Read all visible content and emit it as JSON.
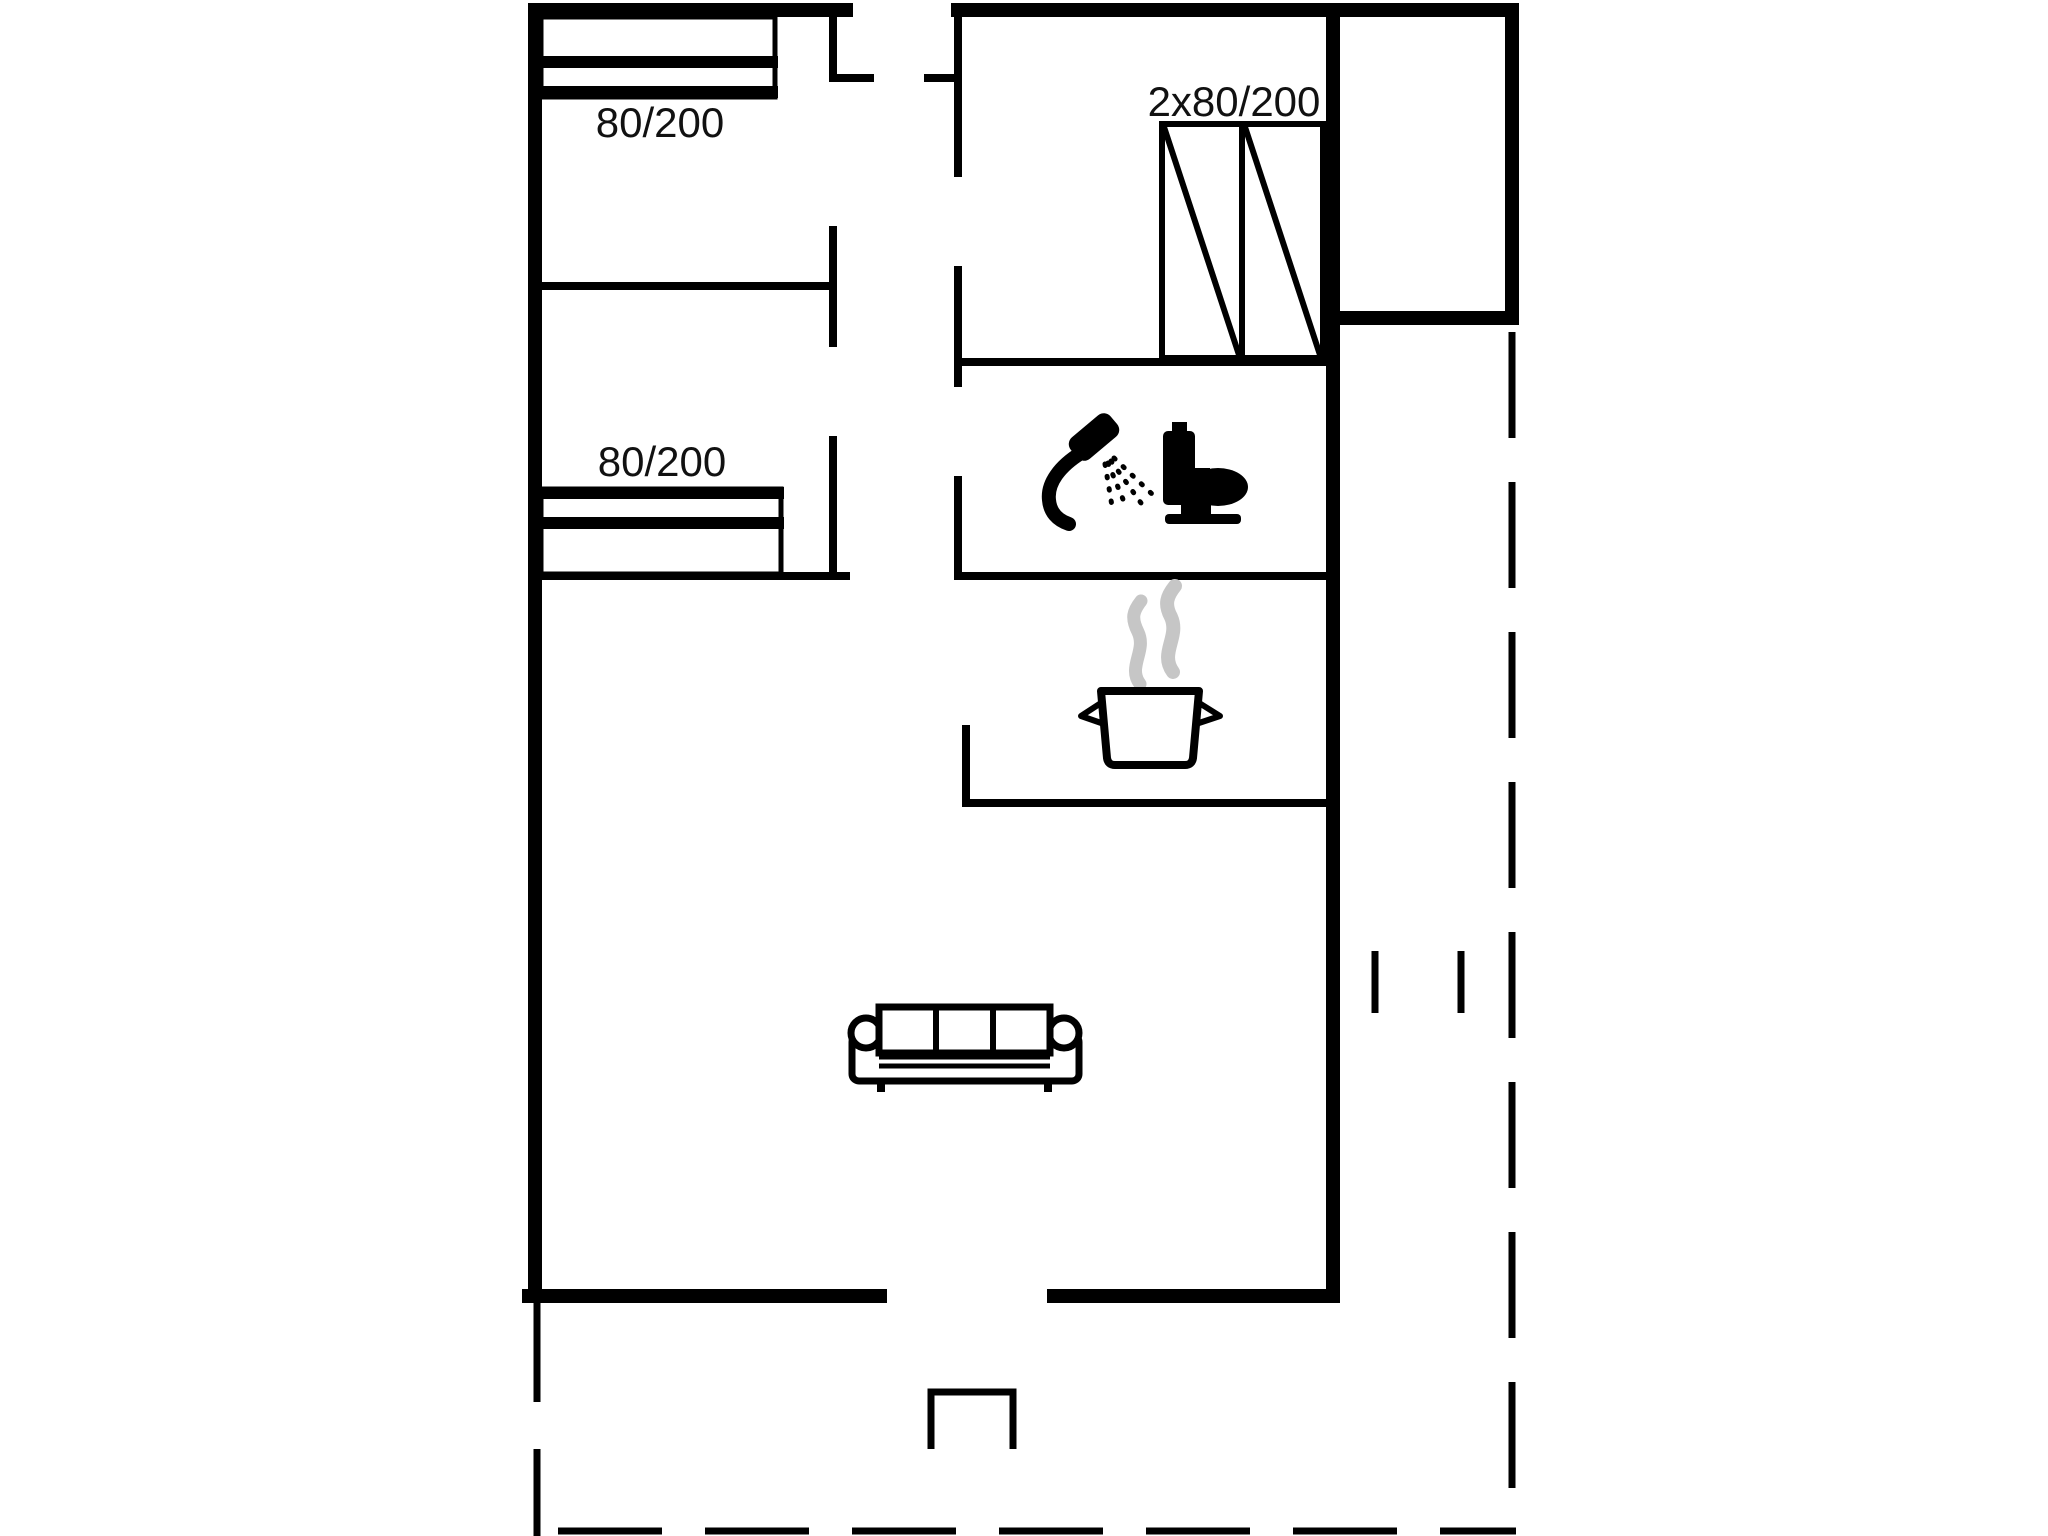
{
  "plan": {
    "type": "holiday-house-floor-plan",
    "labels": {
      "bed_top_left": "80/200",
      "bed_middle_left": "80/200",
      "bunk_bed": "2x80/200"
    },
    "colors": {
      "wall": "#000000",
      "steam": "#c6c6c6",
      "background": "#ffffff",
      "text": "#111111"
    },
    "icons": [
      "single-bed-icon",
      "single-bed-icon",
      "bunk-bed-icon",
      "shower-icon",
      "toilet-icon",
      "cooking-pot-steam-icon",
      "sofa-icon",
      "entrance-step-icon",
      "terrace-dashed-boundary"
    ]
  }
}
